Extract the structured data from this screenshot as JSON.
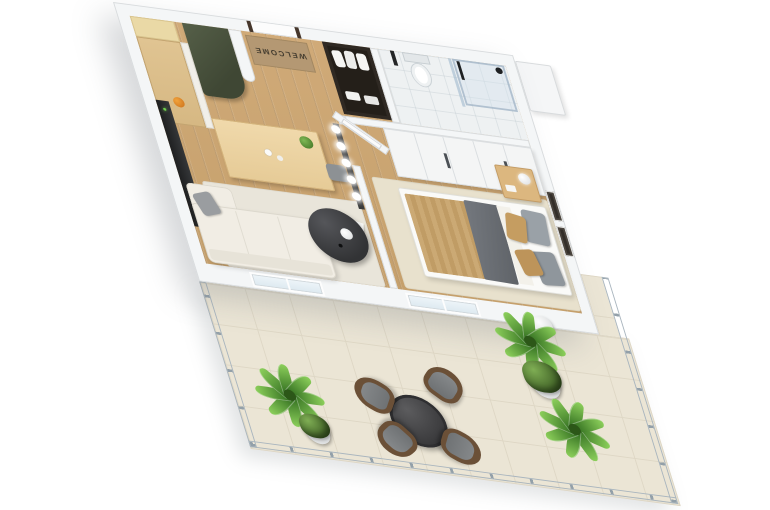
{
  "scene": {
    "background": "#ffffff",
    "description": "3D isometric render of a one-bedroom apartment floor plan with furnished terrace"
  },
  "entry": {
    "doormat_text": "WELCOME",
    "items": [
      "entry-door",
      "welcome-doormat",
      "open-closet-with-clothes"
    ]
  },
  "palette": {
    "wall": "#f4f6f7",
    "wall_edge": "#d8dbdd",
    "wood_floor": "#cba875",
    "bath_floor": "#eef1f2",
    "terrace_tile": "#ebe5d5",
    "tile_grout": "#ded7c5",
    "green_cabinet": "#4a5240",
    "doormat": "#b49873",
    "sofa": "#f1ede4",
    "dining_table": "#ecd2a0",
    "chair_gray": "#8f9396",
    "coffee_table": "#3d3e40",
    "bed_tan": "#c8a672",
    "throw_gray": "#6c7074",
    "nightstand": "#dcb77f",
    "wardrobe": "#f4f5f5",
    "rattan_chair": "#6b5037",
    "outdoor_cushion": "#7b7e80",
    "plant_green": "#6fae3f",
    "glass_railing": "#cddbe5",
    "closet_dark": "#2f2923",
    "tv_unit": "#2a2b2d",
    "orange_fruit": "#df8527"
  },
  "rooms": {
    "kitchen": {
      "items": [
        "upper-cabinet",
        "wood-counter",
        "tall-green-cabinet",
        "fruit-bowl"
      ]
    },
    "bathroom": {
      "items": [
        "toilet",
        "shower-enclosure",
        "glass-partition",
        "black-shower-fixture"
      ]
    },
    "living_dining": {
      "items": [
        "dining-table",
        "dining-chairs",
        "table-plant",
        "sphere-wall-lights",
        "tv-media-unit",
        "sofa",
        "gray-throw-pillow",
        "round-coffee-table",
        "area-rug",
        "pouf",
        "floor-paper"
      ]
    },
    "bedroom": {
      "items": [
        "double-bed",
        "knit-bedspread",
        "gray-throw",
        "pillows",
        "nightstand",
        "table-lamp",
        "wardrobe",
        "wall-art-frames",
        "bedroom-rug"
      ]
    },
    "terrace": {
      "items": [
        "tile-floor",
        "glass-railing",
        "round-outdoor-table",
        "rattan-armchairs",
        "potted-plants"
      ],
      "chair_count": 4,
      "plant_count": 5
    }
  },
  "counts": {
    "dining_chairs": 4,
    "south_window_pairs": 2,
    "wardrobe_doors": 5,
    "wall_light_bulbs": 5
  }
}
